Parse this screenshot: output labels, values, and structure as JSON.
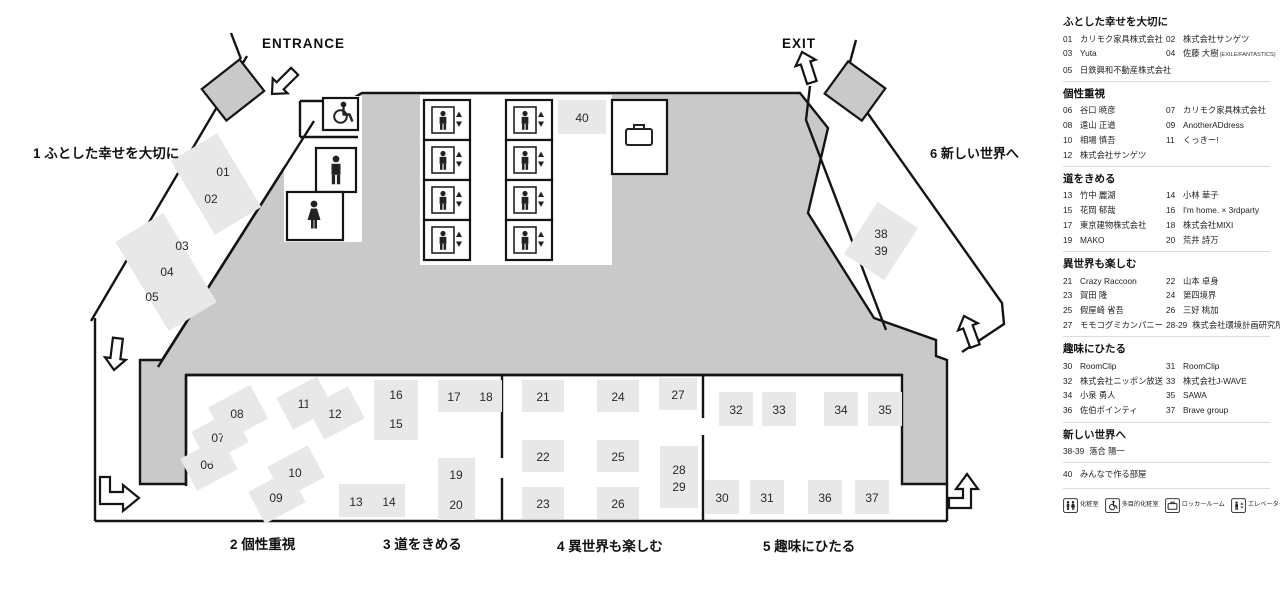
{
  "map": {
    "entrance_label": "ENTRANCE",
    "exit_label": "EXIT",
    "zones": [
      {
        "num": "1",
        "label": "ふとした幸せを大切に"
      },
      {
        "num": "2",
        "label": "個性重視"
      },
      {
        "num": "3",
        "label": "道をきめる"
      },
      {
        "num": "4",
        "label": "異世界も楽しむ"
      },
      {
        "num": "5",
        "label": "趣味にひたる"
      },
      {
        "num": "6",
        "label": "新しい世界へ"
      }
    ],
    "booths": [
      {
        "id": "01-02",
        "lines": [
          "01",
          "02"
        ]
      },
      {
        "id": "03-05",
        "lines": [
          "03",
          "04",
          "05"
        ]
      },
      {
        "id": "06",
        "lines": [
          "06"
        ]
      },
      {
        "id": "07",
        "lines": [
          "07"
        ]
      },
      {
        "id": "08",
        "lines": [
          "08"
        ]
      },
      {
        "id": "09",
        "lines": [
          "09"
        ]
      },
      {
        "id": "10",
        "lines": [
          "10"
        ]
      },
      {
        "id": "11",
        "lines": [
          "11"
        ]
      },
      {
        "id": "12",
        "lines": [
          "12"
        ]
      },
      {
        "id": "16-15",
        "lines": [
          "16",
          "15"
        ]
      },
      {
        "id": "17-18",
        "lines": [
          "17",
          "18"
        ]
      },
      {
        "id": "13-14",
        "lines": [
          "13",
          "14"
        ]
      },
      {
        "id": "19-20",
        "lines": [
          "19",
          "20"
        ]
      },
      {
        "id": "21",
        "lines": [
          "21"
        ]
      },
      {
        "id": "22",
        "lines": [
          "22"
        ]
      },
      {
        "id": "23",
        "lines": [
          "23"
        ]
      },
      {
        "id": "24",
        "lines": [
          "24"
        ]
      },
      {
        "id": "25",
        "lines": [
          "25"
        ]
      },
      {
        "id": "26",
        "lines": [
          "26"
        ]
      },
      {
        "id": "27",
        "lines": [
          "27"
        ]
      },
      {
        "id": "28-29",
        "lines": [
          "28",
          "29"
        ]
      },
      {
        "id": "30",
        "lines": [
          "30"
        ]
      },
      {
        "id": "31",
        "lines": [
          "31"
        ]
      },
      {
        "id": "32",
        "lines": [
          "32"
        ]
      },
      {
        "id": "33",
        "lines": [
          "33"
        ]
      },
      {
        "id": "34",
        "lines": [
          "34"
        ]
      },
      {
        "id": "35",
        "lines": [
          "35"
        ]
      },
      {
        "id": "36",
        "lines": [
          "36"
        ]
      },
      {
        "id": "37",
        "lines": [
          "37"
        ]
      },
      {
        "id": "38-39",
        "lines": [
          "38",
          "39"
        ]
      },
      {
        "id": "40",
        "lines": [
          "40"
        ]
      }
    ]
  },
  "legend": {
    "sections": [
      {
        "title": "ふとした幸せを大切に",
        "entries": [
          {
            "no": "01",
            "name": "カリモク家具株式会社"
          },
          {
            "no": "02",
            "name": "株式会社サンゲツ"
          },
          {
            "no": "03",
            "name": "Yuta"
          },
          {
            "no": "04",
            "name": "佐藤 大樹",
            "suffix": "(EXILE/FANTASTICS)"
          },
          {
            "no": "05",
            "name": "日鉄興和不動産株式会社"
          }
        ]
      },
      {
        "title": "個性重視",
        "entries": [
          {
            "no": "06",
            "name": "谷口 暁彦"
          },
          {
            "no": "07",
            "name": "カリモク家具株式会社"
          },
          {
            "no": "08",
            "name": "遠山 正道"
          },
          {
            "no": "09",
            "name": "AnotherADdress"
          },
          {
            "no": "10",
            "name": "相場 慎吾"
          },
          {
            "no": "11",
            "name": "くっきー!"
          },
          {
            "no": "12",
            "name": "株式会社サンゲツ"
          }
        ]
      },
      {
        "title": "道をきめる",
        "entries": [
          {
            "no": "13",
            "name": "竹中 麗湖"
          },
          {
            "no": "14",
            "name": "小林 華子"
          },
          {
            "no": "15",
            "name": "花岡 郁哉"
          },
          {
            "no": "16",
            "name": "I'm home. × 3rdparty"
          },
          {
            "no": "17",
            "name": "東京建物株式会社"
          },
          {
            "no": "18",
            "name": "株式会社MIXI"
          },
          {
            "no": "19",
            "name": "MAKO"
          },
          {
            "no": "20",
            "name": "荒井 詩万"
          }
        ]
      },
      {
        "title": "異世界も楽しむ",
        "entries": [
          {
            "no": "21",
            "name": "Crazy Raccoon"
          },
          {
            "no": "22",
            "name": "山本 卓身"
          },
          {
            "no": "23",
            "name": "賀田 隆"
          },
          {
            "no": "24",
            "name": "第四境界"
          },
          {
            "no": "25",
            "name": "假屋崎 省吾"
          },
          {
            "no": "26",
            "name": "三好 桃加"
          },
          {
            "no": "27",
            "name": "モモコグミカンパニー"
          },
          {
            "no": "28-29",
            "name": "株式会社環境計画研究所"
          }
        ]
      },
      {
        "title": "趣味にひたる",
        "entries": [
          {
            "no": "30",
            "name": "RoomClip"
          },
          {
            "no": "31",
            "name": "RoomClip"
          },
          {
            "no": "32",
            "name": "株式会社ニッポン放送"
          },
          {
            "no": "33",
            "name": "株式会社J-WAVE"
          },
          {
            "no": "34",
            "name": "小泉 勇人"
          },
          {
            "no": "35",
            "name": "SAWA"
          },
          {
            "no": "36",
            "name": "佐伯ポインティ"
          },
          {
            "no": "37",
            "name": "Brave group"
          }
        ]
      },
      {
        "title": "新しい世界へ",
        "entries": [
          {
            "no": "38-39",
            "name": "落合 陽一"
          }
        ]
      },
      {
        "title": "",
        "entries": [
          {
            "no": "40",
            "name": "みんなで作る部屋"
          }
        ]
      }
    ],
    "facilities": [
      {
        "icon": "restroom-icon",
        "label": "化粧室"
      },
      {
        "icon": "accessible-restroom-icon",
        "label": "多目的化粧室"
      },
      {
        "icon": "locker-room-icon",
        "label": "ロッカールーム"
      },
      {
        "icon": "elevator-icon",
        "label": "エレベーター"
      }
    ]
  },
  "colors": {
    "wall": "#141414",
    "mass": "#c9c9c9",
    "booth": "#e8e8e8",
    "text": "#2a2a2a"
  }
}
